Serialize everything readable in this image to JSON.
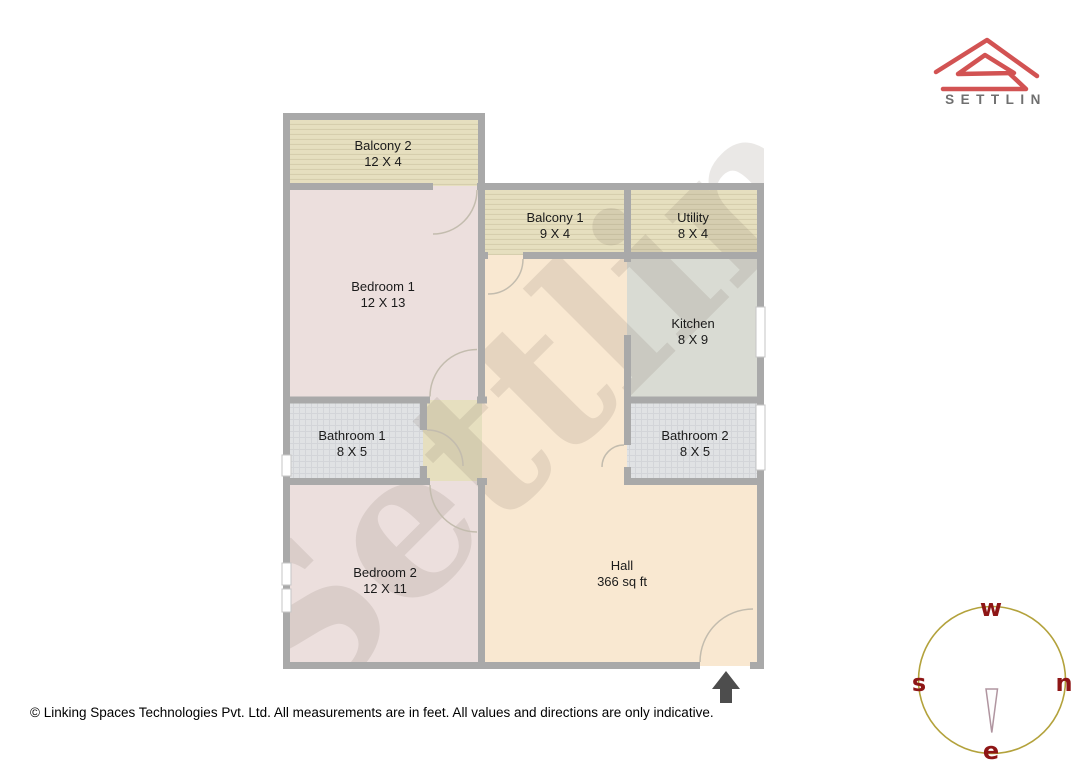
{
  "brand": {
    "name": "SETTLIN"
  },
  "watermark": "Settlin",
  "plan": {
    "rooms": [
      {
        "id": "balcony-2",
        "name": "Balcony 2",
        "dims": "12 X 4"
      },
      {
        "id": "bedroom-1",
        "name": "Bedroom 1",
        "dims": "12 X 13"
      },
      {
        "id": "balcony-1",
        "name": "Balcony 1",
        "dims": "9 X 4"
      },
      {
        "id": "utility",
        "name": "Utility",
        "dims": "8 X 4"
      },
      {
        "id": "kitchen",
        "name": "Kitchen",
        "dims": "8 X 9"
      },
      {
        "id": "bathroom-1",
        "name": "Bathroom 1",
        "dims": "8 X 5"
      },
      {
        "id": "bathroom-2",
        "name": "Bathroom 2",
        "dims": "8 X 5"
      },
      {
        "id": "bedroom-2",
        "name": "Bedroom 2",
        "dims": "12 X 11"
      },
      {
        "id": "hall",
        "name": "Hall",
        "dims": "366 sq ft"
      }
    ]
  },
  "compass": {
    "top": "w",
    "left": "s",
    "right": "n",
    "bottom": "e"
  },
  "footer": "© Linking Spaces Technologies Pvt. Ltd. All measurements are in feet. All values and directions are only indicative.",
  "colors": {
    "wall": "#a9a9a9",
    "balcony": "#e6dfbf",
    "bedroom": "#ecdfdd",
    "kitchen": "#d9dbd3",
    "bathroom": "#e0e2e4",
    "hall": "#f9e8d1",
    "logo_red": "#d25353",
    "compass_circle": "#b3a23c",
    "compass_letter": "#8e1616",
    "arrow": "#4d4d4d"
  }
}
